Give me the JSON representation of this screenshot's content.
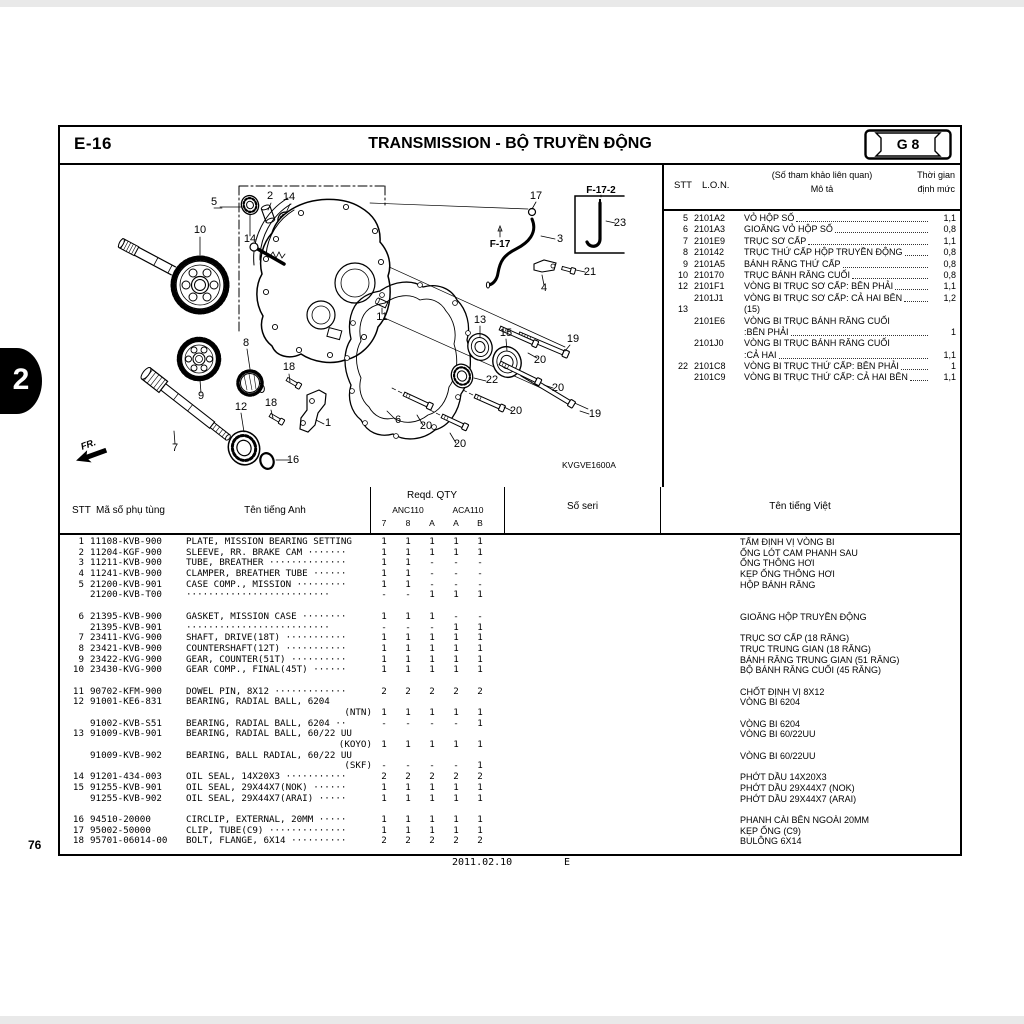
{
  "page": {
    "code": "E-16",
    "title": "TRANSMISSION - BỘ TRUYỀN ĐỘNG",
    "grid_ref": "G 8",
    "section_tab": "2",
    "page_number": "76",
    "footer_date": "2011.02.10",
    "footer_rev": "E",
    "diagram_code": "KVGVE1600A",
    "fr_label": "FR."
  },
  "ref_table": {
    "headers": {
      "stt": "STT",
      "lon": "L.O.N.",
      "desc_line1": "(Số tham khảo liên quan)",
      "desc_line2": "Mô tả",
      "time_line1": "Thời gian",
      "time_line2": "định mức"
    },
    "rows": [
      {
        "stt": "5",
        "lon": "2101A2",
        "desc": "VỎ HỘP SỐ",
        "time": "1,1",
        "leader": true
      },
      {
        "stt": "6",
        "lon": "2101A3",
        "desc": "GIOĂNG VỎ HỘP SỐ",
        "time": "0,8",
        "leader": true
      },
      {
        "stt": "7",
        "lon": "2101E9",
        "desc": "TRỤC SƠ CẤP",
        "time": "1,1",
        "leader": true
      },
      {
        "stt": "8",
        "lon": "210142",
        "desc": "TRỤC THỨ CẤP HỘP TRUYỀN ĐỘNG",
        "time": "0,8",
        "leader": true
      },
      {
        "stt": "9",
        "lon": "2101A5",
        "desc": "BÁNH RĂNG THỨ CẤP",
        "time": "0,8",
        "leader": true
      },
      {
        "stt": "10",
        "lon": "210170",
        "desc": "TRỤC BÁNH RĂNG CUỐI",
        "time": "0,8",
        "leader": true
      },
      {
        "stt": "12",
        "lon": "2101F1",
        "desc": "VÒNG BI TRỤC SƠ CẤP: BÊN PHẢI",
        "time": "1,1",
        "leader": true
      },
      {
        "stt": "",
        "lon": "2101J1",
        "desc": "VÒNG BI TRỤC SƠ CẤP: CẢ HAI BÊN",
        "time": "1,2",
        "leader": true
      },
      {
        "stt": "13",
        "lon": "",
        "desc": "(15)",
        "time": "",
        "leader": false
      },
      {
        "stt": "",
        "lon": "2101E6",
        "desc": "VÒNG BI TRỤC BÁNH RĂNG CUỐI",
        "time": "",
        "leader": false
      },
      {
        "stt": "",
        "lon": "",
        "desc": ":BÊN PHẢI",
        "time": "1",
        "leader": true
      },
      {
        "stt": "",
        "lon": "2101J0",
        "desc": "VÒNG BI TRỤC BÁNH RĂNG CUỐI",
        "time": "",
        "leader": false
      },
      {
        "stt": "",
        "lon": "",
        "desc": ":CẢ HAI",
        "time": "1,1",
        "leader": true
      },
      {
        "stt": "22",
        "lon": "2101C8",
        "desc": "VÒNG BI TRỤC THỨ CẤP: BÊN PHẢI",
        "time": "1",
        "leader": true
      },
      {
        "stt": "",
        "lon": "2101C9",
        "desc": "VÒNG BI TRỤC THỨ CẤP: CẢ HAI BÊN",
        "time": "1,1",
        "leader": true
      }
    ]
  },
  "parts_table": {
    "headers": {
      "stt": "STT",
      "part": "Mã số phụ tùng",
      "name_en": "Tên tiếng Anh",
      "reqd": "Reqd.  QTY",
      "anc": "ANC110",
      "aca": "ACA110",
      "sub": [
        "7",
        "8",
        "A",
        "A",
        "B"
      ],
      "seri": "Số seri",
      "name_vi": "Tên tiếng Việt"
    },
    "lines": [
      {
        "stt": "1",
        "part": "11108-KVB-900",
        "name": "PLATE, MISSION BEARING SETTING",
        "qty": [
          "1",
          "1",
          "1",
          "1",
          "1"
        ],
        "viet": "TẤM ĐỊNH VỊ VÒNG BI"
      },
      {
        "stt": "2",
        "part": "11204-KGF-900",
        "name": "SLEEVE, RR. BRAKE CAM ·······",
        "qty": [
          "1",
          "1",
          "1",
          "1",
          "1"
        ],
        "viet": "ỐNG LÓT CAM PHANH SAU"
      },
      {
        "stt": "3",
        "part": "11211-KVB-900",
        "name": "TUBE, BREATHER ··············",
        "qty": [
          "1",
          "1",
          "-",
          "-",
          "-"
        ],
        "viet": "ỐNG THÔNG HƠI"
      },
      {
        "stt": "4",
        "part": "11241-KVB-900",
        "name": "CLAMPER, BREATHER TUBE ······",
        "qty": [
          "1",
          "1",
          "-",
          "-",
          "-"
        ],
        "viet": "KẸP ỐNG THÔNG HƠI"
      },
      {
        "stt": "5",
        "part": "21200-KVB-901",
        "name": "CASE COMP., MISSION ·········",
        "qty": [
          "1",
          "1",
          "-",
          "-",
          "-"
        ],
        "viet": "HỘP BÁNH RĂNG"
      },
      {
        "stt": "",
        "part": "21200-KVB-T00",
        "name": "··························",
        "qty": [
          "-",
          "-",
          "1",
          "1",
          "1"
        ],
        "viet": ""
      },
      {
        "blank": true
      },
      {
        "stt": "6",
        "part": "21395-KVB-900",
        "name": "GASKET, MISSION CASE ········",
        "qty": [
          "1",
          "1",
          "1",
          "-",
          "-"
        ],
        "viet": "GIOĂNG HỘP TRUYỀN ĐỘNG"
      },
      {
        "stt": "",
        "part": "21395-KVB-901",
        "name": "··························",
        "qty": [
          "-",
          "-",
          "-",
          "1",
          "1"
        ],
        "viet": ""
      },
      {
        "stt": "7",
        "part": "23411-KVG-900",
        "name": "SHAFT, DRIVE(18T) ···········",
        "qty": [
          "1",
          "1",
          "1",
          "1",
          "1"
        ],
        "viet": "TRỤC SƠ CẤP (18 RĂNG)"
      },
      {
        "stt": "8",
        "part": "23421-KVB-900",
        "name": "COUNTERSHAFT(12T) ···········",
        "qty": [
          "1",
          "1",
          "1",
          "1",
          "1"
        ],
        "viet": "TRỤC TRUNG GIAN (18 RĂNG)"
      },
      {
        "stt": "9",
        "part": "23422-KVG-900",
        "name": "GEAR, COUNTER(51T) ··········",
        "qty": [
          "1",
          "1",
          "1",
          "1",
          "1"
        ],
        "viet": "BÁNH RĂNG TRUNG GIAN (51 RĂNG)"
      },
      {
        "stt": "10",
        "part": "23430-KVG-900",
        "name": "GEAR COMP., FINAL(45T) ······",
        "qty": [
          "1",
          "1",
          "1",
          "1",
          "1"
        ],
        "viet": "BỘ BÁNH RĂNG CUỐI (45 RĂNG)"
      },
      {
        "blank": true
      },
      {
        "stt": "11",
        "part": "90702-KFM-900",
        "name": "DOWEL PIN, 8X12 ·············",
        "qty": [
          "2",
          "2",
          "2",
          "2",
          "2"
        ],
        "viet": "CHỐT ĐỊNH VỊ 8X12"
      },
      {
        "stt": "12",
        "part": "91001-KE6-831",
        "name": "BEARING, RADIAL BALL, 6204",
        "qty": [
          "",
          "",
          "",
          "",
          ""
        ],
        "viet": "VÒNG BI 6204"
      },
      {
        "stt": "",
        "part": "",
        "name": "(NTN)",
        "align": "right",
        "qty": [
          "1",
          "1",
          "1",
          "1",
          "1"
        ],
        "viet": ""
      },
      {
        "stt": "",
        "part": "91002-KVB-S51",
        "name": "BEARING, RADIAL BALL, 6204 ··",
        "qty": [
          "-",
          "-",
          "-",
          "-",
          "1"
        ],
        "viet": "VÒNG BI 6204"
      },
      {
        "stt": "13",
        "part": "91009-KVB-901",
        "name": "BEARING, RADIAL BALL, 60/22 UU",
        "qty": [
          "",
          "",
          "",
          "",
          ""
        ],
        "viet": "VÒNG BI 60/22UU"
      },
      {
        "stt": "",
        "part": "",
        "name": "(KOYO)",
        "align": "right",
        "qty": [
          "1",
          "1",
          "1",
          "1",
          "1"
        ],
        "viet": ""
      },
      {
        "stt": "",
        "part": "91009-KVB-902",
        "name": "BEARING, BALL RADIAL, 60/22 UU",
        "qty": [
          "",
          "",
          "",
          "",
          ""
        ],
        "viet": "VÒNG BI 60/22UU"
      },
      {
        "stt": "",
        "part": "",
        "name": "(SKF)",
        "align": "right",
        "qty": [
          "-",
          "-",
          "-",
          "-",
          "1"
        ],
        "viet": ""
      },
      {
        "stt": "14",
        "part": "91201-434-003",
        "name": "OIL SEAL, 14X20X3 ···········",
        "qty": [
          "2",
          "2",
          "2",
          "2",
          "2"
        ],
        "viet": "PHỚT DẦU 14X20X3"
      },
      {
        "stt": "15",
        "part": "91255-KVB-901",
        "name": "OIL SEAL, 29X44X7(NOK) ······",
        "qty": [
          "1",
          "1",
          "1",
          "1",
          "1"
        ],
        "viet": "PHỚT DẦU 29X44X7 (NOK)"
      },
      {
        "stt": "",
        "part": "91255-KVB-902",
        "name": "OIL SEAL, 29X44X7(ARAI) ·····",
        "qty": [
          "1",
          "1",
          "1",
          "1",
          "1"
        ],
        "viet": "PHỚT DẦU 29X44X7 (ARAI)"
      },
      {
        "blank": true
      },
      {
        "stt": "16",
        "part": "94510-20000",
        "name": "CIRCLIP, EXTERNAL, 20MM ·····",
        "qty": [
          "1",
          "1",
          "1",
          "1",
          "1"
        ],
        "viet": "PHANH CÀI BÊN NGOÀI 20MM"
      },
      {
        "stt": "17",
        "part": "95002-50000",
        "name": "CLIP, TUBE(C9) ··············",
        "qty": [
          "1",
          "1",
          "1",
          "1",
          "1"
        ],
        "viet": "KẸP ỐNG (C9)"
      },
      {
        "stt": "18",
        "part": "95701-06014-00",
        "name": "BOLT, FLANGE, 6X14 ··········",
        "qty": [
          "2",
          "2",
          "2",
          "2",
          "2"
        ],
        "viet": "BULÔNG 6X14"
      }
    ]
  },
  "diagram": {
    "callouts": [
      {
        "t": "5",
        "x": 154,
        "y": 42
      },
      {
        "t": "2",
        "x": 210,
        "y": 36
      },
      {
        "t": "14",
        "x": 229,
        "y": 37
      },
      {
        "t": "14",
        "x": 190,
        "y": 79
      },
      {
        "t": "10",
        "x": 140,
        "y": 70
      },
      {
        "t": "17",
        "x": 476,
        "y": 36
      },
      {
        "t": "23",
        "x": 560,
        "y": 63
      },
      {
        "t": "3",
        "x": 500,
        "y": 79
      },
      {
        "t": "21",
        "x": 530,
        "y": 112
      },
      {
        "t": "4",
        "x": 484,
        "y": 128
      },
      {
        "t": "11",
        "x": 322,
        "y": 157
      },
      {
        "t": "13",
        "x": 420,
        "y": 160
      },
      {
        "t": "15",
        "x": 446,
        "y": 173
      },
      {
        "t": "19",
        "x": 513,
        "y": 179
      },
      {
        "t": "20",
        "x": 480,
        "y": 200
      },
      {
        "t": "22",
        "x": 432,
        "y": 220
      },
      {
        "t": "20",
        "x": 498,
        "y": 228
      },
      {
        "t": "8",
        "x": 186,
        "y": 183
      },
      {
        "t": "18",
        "x": 229,
        "y": 207
      },
      {
        "t": "18",
        "x": 211,
        "y": 243
      },
      {
        "t": "9",
        "x": 141,
        "y": 236
      },
      {
        "t": "12",
        "x": 181,
        "y": 247
      },
      {
        "t": "1",
        "x": 268,
        "y": 263
      },
      {
        "t": "6",
        "x": 338,
        "y": 260
      },
      {
        "t": "20",
        "x": 456,
        "y": 251
      },
      {
        "t": "19",
        "x": 535,
        "y": 254
      },
      {
        "t": "20",
        "x": 366,
        "y": 266
      },
      {
        "t": "20",
        "x": 400,
        "y": 284
      },
      {
        "t": "7",
        "x": 115,
        "y": 288
      },
      {
        "t": "16",
        "x": 233,
        "y": 300
      }
    ],
    "bold_callouts": [
      {
        "t": "F-17",
        "x": 440,
        "y": 84
      },
      {
        "t": "F-17-2",
        "x": 541,
        "y": 30
      }
    ]
  }
}
